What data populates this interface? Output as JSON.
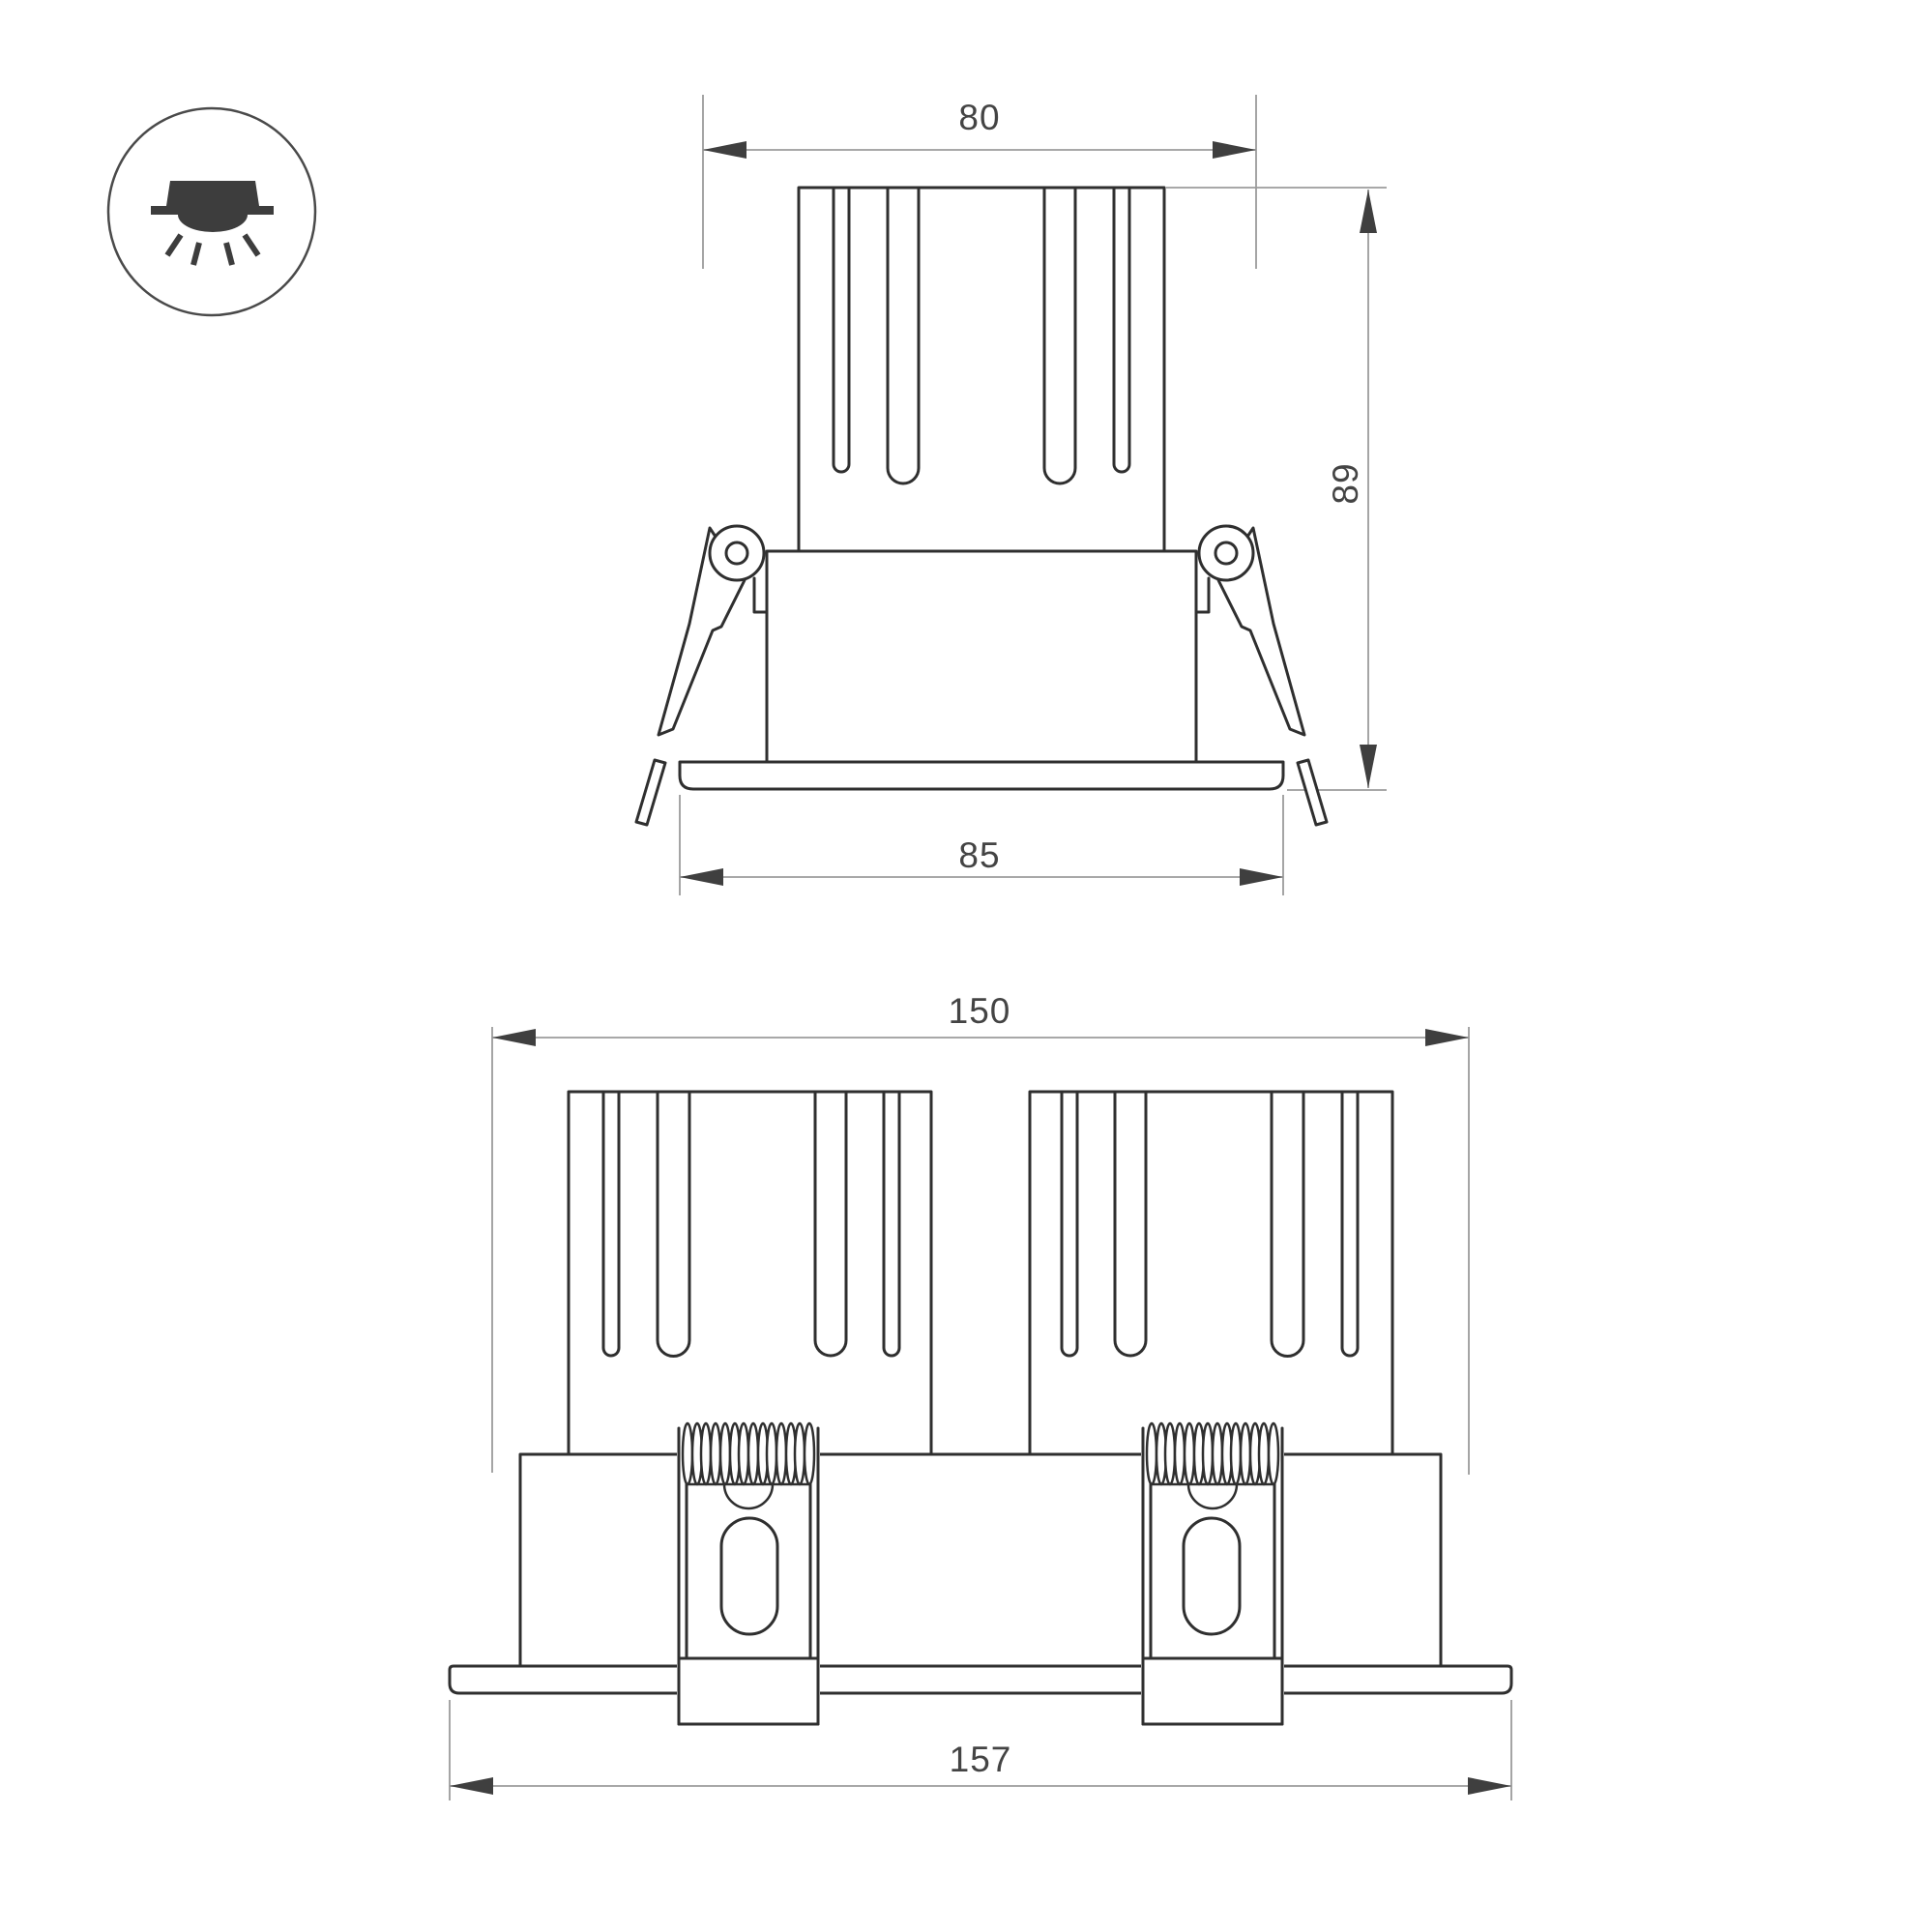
{
  "colors": {
    "geometry": "#2f2f2f",
    "dimension_line": "#9b9b9b",
    "arrowhead": "#3f3f3f",
    "dimension_text": "#444444",
    "icon_glyph": "#3d3d3d",
    "icon_outline": "#4a4a4a"
  },
  "icon": {
    "name": "recessed-downlight"
  },
  "views": {
    "single": {
      "dimensions": {
        "cutout_width": "80",
        "height": "89",
        "flange_width": "85"
      }
    },
    "double": {
      "dimensions": {
        "overall_width": "150",
        "flange_width": "157"
      }
    }
  }
}
